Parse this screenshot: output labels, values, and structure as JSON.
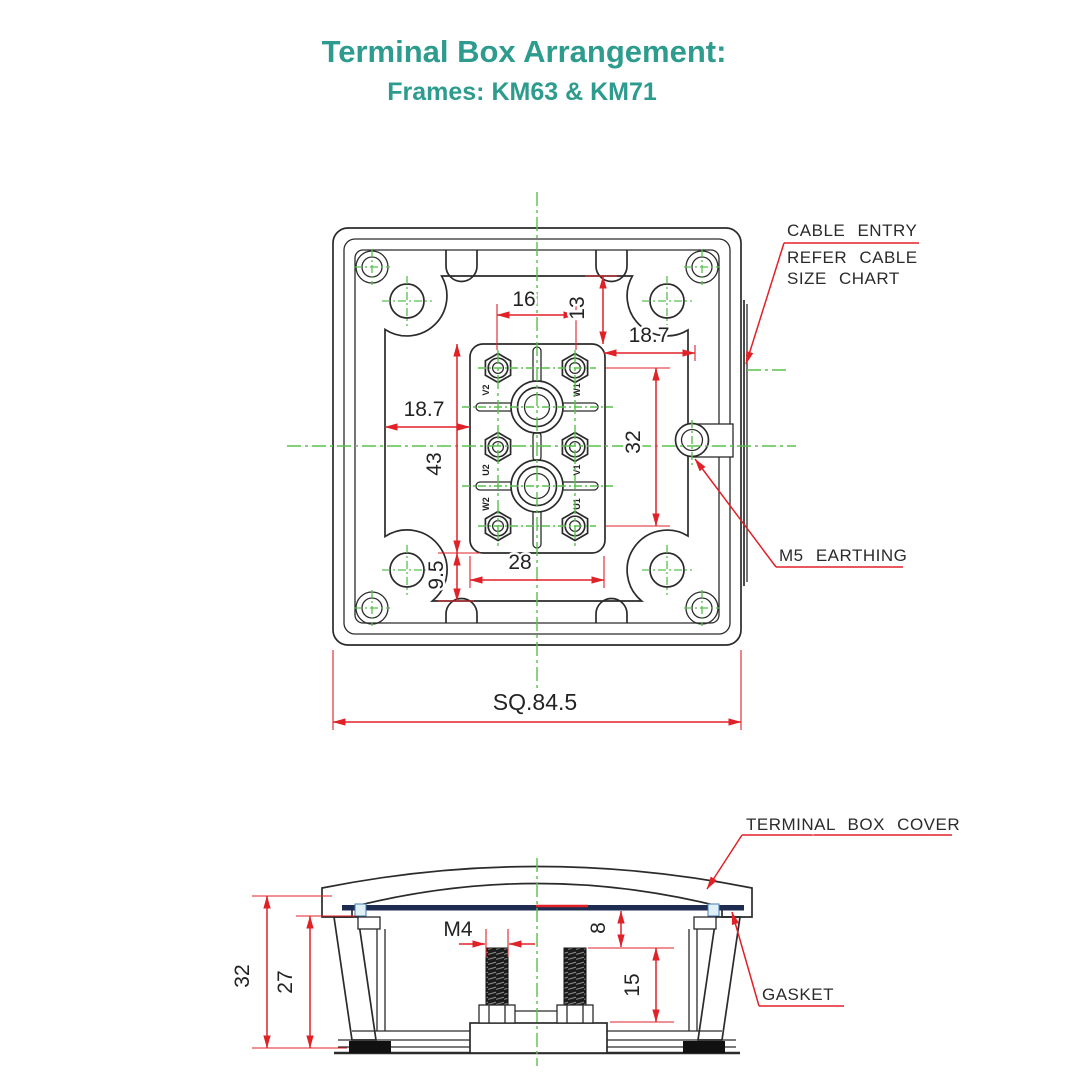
{
  "header": {
    "title": "Terminal Box Arrangement:",
    "subtitle": "Frames: KM63 & KM71"
  },
  "colors": {
    "accent_teal": "#2d9b8d",
    "dimension_red": "#e02128",
    "centerline_green": "#58c04c",
    "hatch_cyan": "#9bd7e6",
    "gasket_navy": "#1e2c52",
    "line_black": "#2b2b2b"
  },
  "top_view": {
    "dims": {
      "pitch_x": "16",
      "top_offset": "13",
      "right_offset": "18.7",
      "left_offset": "18.7",
      "pitch_y": "32",
      "block_height": "43",
      "block_width": "28",
      "bottom_offset": "9.5",
      "overall_square": "SQ.84.5"
    },
    "terminals": [
      "V2",
      "W1",
      "U2",
      "V1",
      "W2",
      "U1"
    ],
    "callouts": {
      "cable_entry_line1": "CABLE ENTRY",
      "cable_entry_line2": "REFER CABLE",
      "cable_entry_line3": "SIZE CHART",
      "earthing": "M5 EARTHING"
    }
  },
  "section_view": {
    "dims": {
      "overall_height": "32",
      "inner_height": "27",
      "stud_size": "M4",
      "cover_clearance": "8",
      "stud_length": "15"
    },
    "callouts": {
      "cover": "TERMINAL BOX COVER",
      "gasket": "GASKET"
    }
  }
}
